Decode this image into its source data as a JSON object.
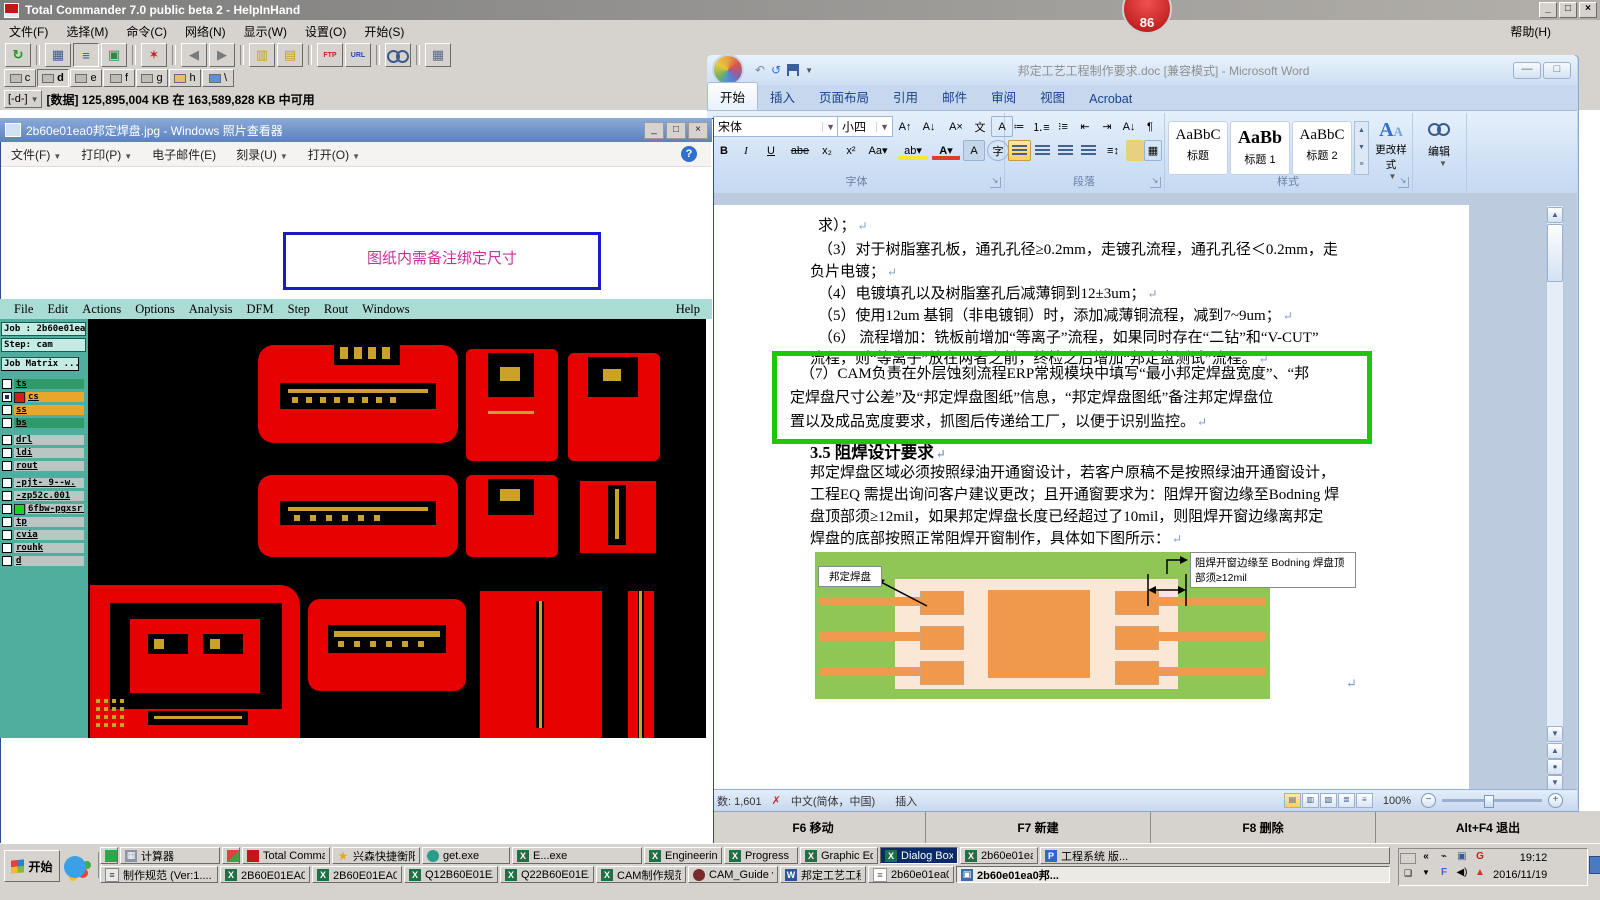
{
  "tc": {
    "title": "Total Commander 7.0 public beta 2 - HelpInHand",
    "menus": [
      "文件(F)",
      "选择(M)",
      "命令(C)",
      "网络(N)",
      "显示(W)",
      "设置(O)",
      "开始(S)"
    ],
    "help_menu": "帮助(H)",
    "toolbar": {
      "ftp": "FTP",
      "url": "URL"
    },
    "drives": [
      "c",
      "d",
      "e",
      "f",
      "g",
      "h",
      "\\"
    ],
    "drive_selector": "[-d-]",
    "drive_info": "[数据] 125,895,004 KB 在 163,589,828 KB 中可用",
    "fkeys": [
      "F6 移动",
      "F7 新建",
      "F8 删除",
      "Alt+F4 退出"
    ]
  },
  "badge": {
    "value": "86"
  },
  "photo": {
    "title": "2b60e01ea0邦定焊盘.jpg - Windows 照片查看器",
    "menus": [
      "文件(F)",
      "打印(P)",
      "电子邮件(E)",
      "刻录(U)",
      "打开(O)"
    ],
    "help": "?",
    "note": "图纸内需备注绑定尺寸"
  },
  "cam": {
    "menus": [
      "File",
      "Edit",
      "Actions",
      "Options",
      "Analysis",
      "DFM",
      "Step",
      "Rout",
      "Windows"
    ],
    "help": "Help",
    "job": "Job : 2b60e01ea0",
    "step": "Step: cam",
    "matrix": "Job Matrix ...",
    "layers": [
      "ts",
      "cs",
      "ss",
      "bs",
      "drl",
      "ldi",
      "rout",
      "-pjt- 9--w.",
      "-zp52c.001",
      "6fbw-pgxsr.",
      "tp",
      "cvia",
      "rouhk",
      "d"
    ]
  },
  "word": {
    "title": "邦定工艺工程制作要求.doc [兼容模式] - Microsoft Word",
    "tabs": [
      "开始",
      "插入",
      "页面布局",
      "引用",
      "邮件",
      "审阅",
      "视图",
      "Acrobat"
    ],
    "font_name": "宋体",
    "font_size": "小四",
    "groups": {
      "font": "字体",
      "paragraph": "段落",
      "styles": "样式",
      "editing": "编辑"
    },
    "styles": [
      {
        "preview": "AaBbC",
        "name": "标题"
      },
      {
        "preview": "AaBb",
        "name": "标题 1"
      },
      {
        "preview": "AaBbC",
        "name": "标题 2"
      }
    ],
    "change_styles": "更改样式",
    "doc": {
      "lines": [
        "求）；",
        "（3）对于树脂塞孔板，通孔孔径≥0.2mm，走镀孔流程，通孔孔径＜0.2mm，走",
        "负片电镀；",
        "（4）电镀填孔以及树脂塞孔后减薄铜到12±3um；",
        "（5）使用12um 基铜（非电镀铜）时，添加减薄铜流程，减到7~9um；",
        "（6） 流程增加：铣板前增加“等离子”流程，如果同时存在“二钻”和“V-CUT”",
        "流程，则“等离子”放在两者之前，终检之后增加“邦定盘测试”流程。"
      ],
      "box_lines": [
        "（7）CAM负责在外层蚀刻流程ERP常规模块中填写“最小邦定焊盘宽度”、“邦",
        "定焊盘尺寸公差”及“邦定焊盘图纸”信息，“邦定焊盘图纸”备注邦定焊盘位",
        "置以及成品宽度要求，抓图后传递给工厂，以便于识别监控。"
      ],
      "heading": "3.5  阻焊设计要求",
      "para": [
        "邦定焊盘区域必须按照绿油开通窗设计，若客户原稿不是按照绿油开通窗设计，",
        "工程EQ 需提出询问客户建议更改；且开通窗要求为：阻焊开窗边缘至Bodning 焊",
        "盘顶部须≥12mil，如果邦定焊盘长度已经超过了10mil，则阻焊开窗边缘离邦定",
        "焊盘的底部按照正常阻焊开窗制作，具体如下图所示："
      ]
    },
    "diagram": {
      "label_left": "邦定焊盘",
      "label_right_line1": "阻焊开窗边缘至 Bodning 焊盘顶",
      "label_right_line2": "部须≥12mil"
    },
    "status": {
      "words": "数: 1,601",
      "lang": "中文(简体，中国)",
      "insert": "插入",
      "zoom": "100%"
    }
  },
  "taskbar": {
    "start": "开始",
    "row1": [
      "计算器",
      "Total Commande...",
      "兴森快捷衡阳...",
      "get.exe",
      "E...exe",
      "Engineering Tool...",
      "Progress",
      "Graphic Editor 9....",
      "Dialog Box",
      "2b60e01ea0 - m...",
      "工程系统  版..."
    ],
    "row2": [
      "制作规范 (Ver:1....",
      "2B60E01EA0制作...",
      "2B60E01EA0-预...",
      "Q12B60E01EA0(...",
      "Q22B60E01EA0(...",
      "CAM制作规范.xl...",
      "CAM_Guide v2.63",
      "邦定工艺工程制...",
      "2b60e01ea0.txt -...",
      "2b60e01ea0邦..."
    ],
    "tray": {
      "time": "19:12",
      "date": "2016/11/19"
    }
  }
}
